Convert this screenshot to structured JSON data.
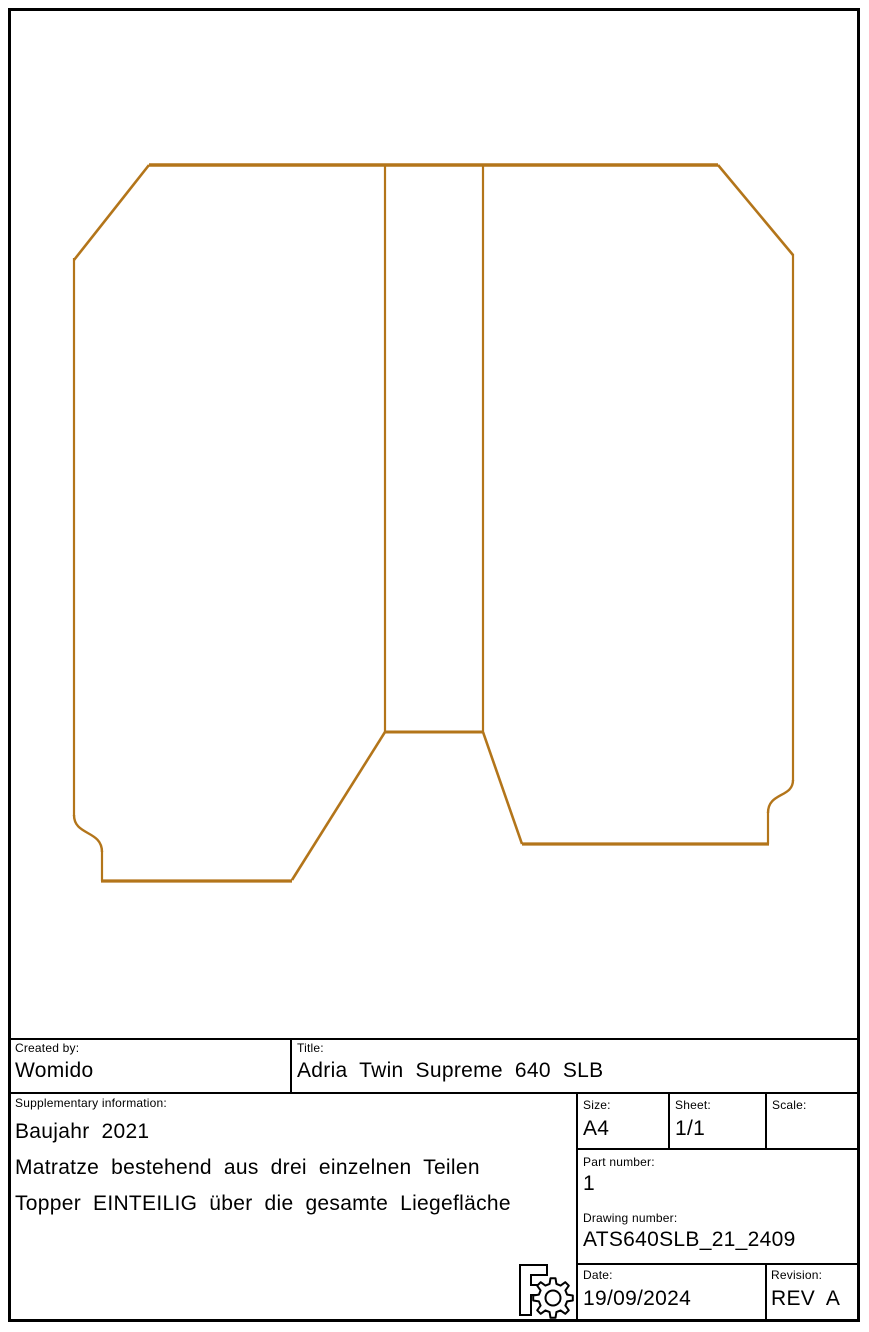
{
  "drawing": {
    "stroke_color": "#B3751A",
    "paths": [
      {
        "name": "top-edge",
        "d": "M149,165 H718",
        "w": 3.4
      },
      {
        "name": "left-chamfer",
        "d": "M149,165 L74,260",
        "w": 2.6
      },
      {
        "name": "left-edge",
        "d": "M74,258 V816",
        "w": 2.2
      },
      {
        "name": "left-notch-curve",
        "d": "M74,815 C74,836 102,830 102,852",
        "w": 2.4
      },
      {
        "name": "left-notch-edge",
        "d": "M102,851 V881",
        "w": 2.2
      },
      {
        "name": "left-bottom-edge",
        "d": "M101,881 H292",
        "w": 3.2
      },
      {
        "name": "left-diagonal",
        "d": "M292,880 L385,732",
        "w": 2.6
      },
      {
        "name": "center-strip-left-edge",
        "d": "M385,165 V732",
        "w": 2.2
      },
      {
        "name": "center-strip-right-edge",
        "d": "M483,165 V732",
        "w": 2.2
      },
      {
        "name": "center-strip-bottom-edge",
        "d": "M385,732 H483",
        "w": 3.0
      },
      {
        "name": "right-diagonal",
        "d": "M483,732 L522,844",
        "w": 2.6
      },
      {
        "name": "right-bottom-edge",
        "d": "M522,844 H769",
        "w": 3.2
      },
      {
        "name": "right-notch-edge",
        "d": "M768,844 V812",
        "w": 2.2
      },
      {
        "name": "right-notch-curve",
        "d": "M793,780 C793,798 768,792 768,813",
        "w": 2.4
      },
      {
        "name": "right-edge",
        "d": "M793,781 V254",
        "w": 2.2
      },
      {
        "name": "right-chamfer",
        "d": "M718,165 L793,255",
        "w": 2.6
      }
    ]
  },
  "title_block": {
    "created_by": {
      "label": "Created by:",
      "value": "Womido"
    },
    "title": {
      "label": "Title:",
      "value": "Adria Twin Supreme 640 SLB"
    },
    "supplementary": {
      "label": "Supplementary information:",
      "lines": [
        "Baujahr 2021",
        "Matratze bestehend aus drei einzelnen Teilen",
        "Topper EINTEILIG über die gesamte Liegefläche"
      ]
    },
    "size": {
      "label": "Size:",
      "value": "A4"
    },
    "sheet": {
      "label": "Sheet:",
      "value": "1/1"
    },
    "scale": {
      "label": "Scale:",
      "value": ""
    },
    "part_number": {
      "label": "Part number:",
      "value": "1"
    },
    "drawing_number": {
      "label": "Drawing number:",
      "value": "ATS640SLB_21_2409"
    },
    "date": {
      "label": "Date:",
      "value": "19/09/2024"
    },
    "revision": {
      "label": "Revision:",
      "value": "REV A"
    }
  }
}
